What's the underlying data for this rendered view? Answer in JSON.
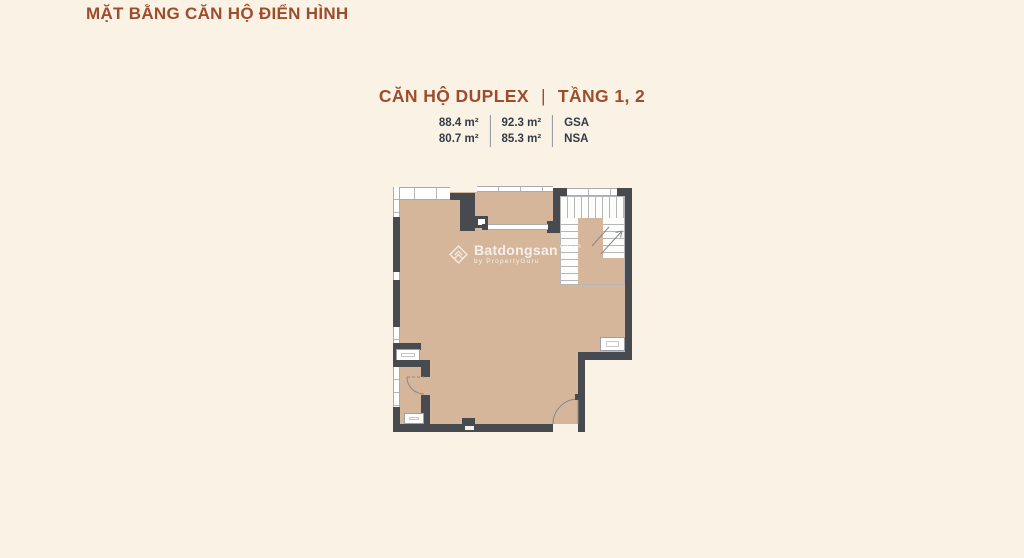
{
  "page": {
    "title": "MẶT BẰNG CĂN HỘ ĐIỂN HÌNH"
  },
  "unit_header": {
    "name": "CĂN HỘ DUPLEX",
    "separator": "|",
    "floors": "TẦNG 1, 2"
  },
  "specs": {
    "columns": [
      {
        "row1": "88.4 m²",
        "row2": "80.7 m²"
      },
      {
        "row1": "92.3 m²",
        "row2": "85.3 m²"
      },
      {
        "row1": "GSA",
        "row2": "NSA"
      }
    ]
  },
  "watermark": {
    "logo": "batdongsan-diamond-icon",
    "brand": "Batdongsan",
    "domain": "com.vn",
    "byline": "by PropertyGuru"
  },
  "colors": {
    "bg": "#faf2e4",
    "accent": "#9e4c2b",
    "tan": "#d5b69a",
    "wall": "#474a4f",
    "line": "#a9abad",
    "stairline": "#b4b6b8",
    "text-dark": "#333b46"
  }
}
